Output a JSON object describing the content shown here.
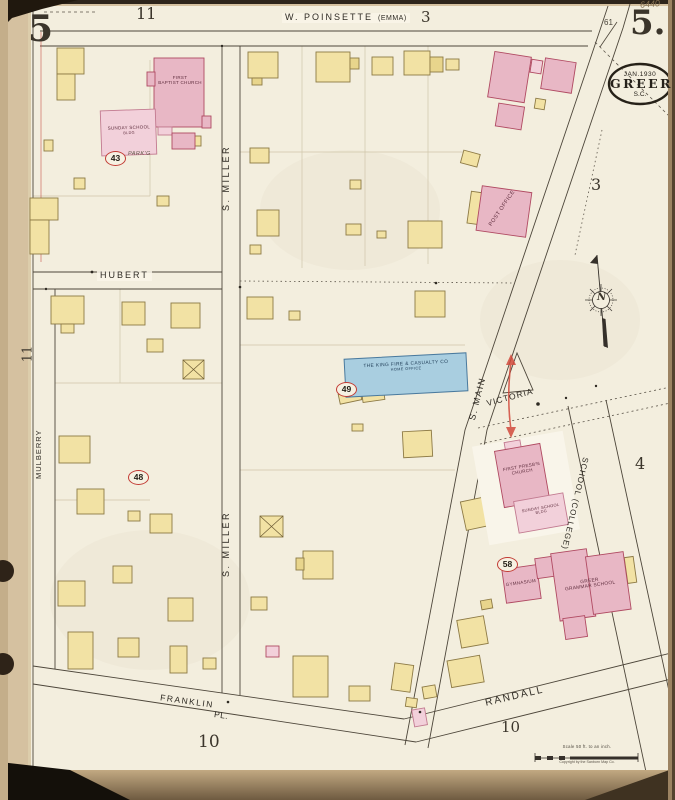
{
  "meta": {
    "sheet_number_left": "5",
    "sheet_number_right": "5.",
    "plate_ref": "61",
    "handwritten_note": "6440",
    "stamp_date": "JAN.1930",
    "stamp_city": "GREER",
    "stamp_state": "S.C.",
    "scale_text": "Scale 50 ft. to an inch.",
    "copyright_text": "Copyright by the Sanborn Map Co.",
    "compass_label": "N"
  },
  "streets": {
    "poinsette": "W. POINSETTE",
    "poinsette_alt": "(EMMA)",
    "miller_upper": "S. MILLER",
    "miller_lower": "S. MILLER",
    "hubert": "HUBERT",
    "mulberry": "MULBERRY",
    "main": "S. MAIN",
    "victoria": "VICTORIA",
    "school": "SCHOOL (COLLEGE)",
    "randall": "RANDALL",
    "franklin": "FRANKLIN",
    "franklin_alt": "PL."
  },
  "blocks": {
    "top_left": "11",
    "top_center": "3",
    "right_upper": "3",
    "left_mid": "11",
    "right_mid": "4",
    "bottom_center": "10",
    "bottom_right": "10"
  },
  "lots": {
    "n43": "43",
    "n48": "48",
    "n49": "49",
    "n58": "58"
  },
  "buildings": {
    "baptist_line1": "FIRST",
    "baptist_line2": "BAPTIST CHURCH",
    "baptist_ss_line1": "SUNDAY SCHOOL",
    "baptist_ss_line2": "BLDG",
    "parking": "PARK'G",
    "post_office": "POST OFFICE",
    "king_line1": "THE KING FIRE & CASUALTY CO",
    "king_line2": "HOME OFFICE",
    "presb_line1": "FIRST PRESB'N",
    "presb_line2": "CHURCH",
    "presb_ss_line1": "SUNDAY SCHOOL",
    "presb_ss_line2": "BLDG",
    "gymnasium": "GYMNASIUM",
    "grammar_line1": "GREER",
    "grammar_line2": "GRAMMAR SCHOOL"
  },
  "colors": {
    "frame_building_yellow": "#f2e2a4",
    "brick_building_pink": "#e8b7c5",
    "special_building_blue": "#a9cee0",
    "annotation_red": "#c23b34",
    "paper": "#f3eede"
  }
}
